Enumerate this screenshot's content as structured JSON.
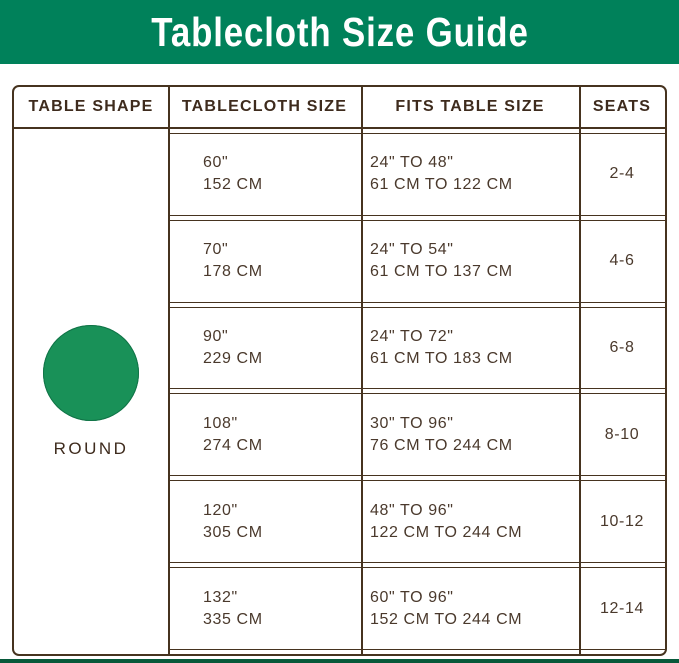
{
  "banner": {
    "title": "Tablecloth Size Guide"
  },
  "colors": {
    "banner_green": "#00815A",
    "circle_green": "#199158",
    "footer_green": "#07593A",
    "border_brown": "#46331F",
    "header_text": "#3E2B1D",
    "body_text": "#4A392C"
  },
  "table": {
    "headers": [
      "TABLE SHAPE",
      "TABLECLOTH SIZE",
      "FITS TABLE SIZE",
      "SEATS"
    ],
    "shape": {
      "icon": "round-circle-icon",
      "label": "ROUND"
    },
    "rows": [
      {
        "size_in": "60\"",
        "size_cm": "152 CM",
        "fits_in": "24\" TO 48\"",
        "fits_cm": "61 CM TO 122 CM",
        "seats": "2-4"
      },
      {
        "size_in": "70\"",
        "size_cm": "178 CM",
        "fits_in": "24\" TO 54\"",
        "fits_cm": "61 CM TO 137 CM",
        "seats": "4-6"
      },
      {
        "size_in": "90\"",
        "size_cm": "229 CM",
        "fits_in": "24\" TO 72\"",
        "fits_cm": "61 CM TO 183 CM",
        "seats": "6-8"
      },
      {
        "size_in": "108\"",
        "size_cm": "274 CM",
        "fits_in": "30\" TO 96\"",
        "fits_cm": "76 CM TO 244 CM",
        "seats": "8-10"
      },
      {
        "size_in": "120\"",
        "size_cm": "305 CM",
        "fits_in": "48\" TO 96\"",
        "fits_cm": "122 CM TO 244 CM",
        "seats": "10-12"
      },
      {
        "size_in": "132\"",
        "size_cm": "335 CM",
        "fits_in": "60\" TO 96\"",
        "fits_cm": "152 CM TO 244 CM",
        "seats": "12-14"
      }
    ]
  }
}
